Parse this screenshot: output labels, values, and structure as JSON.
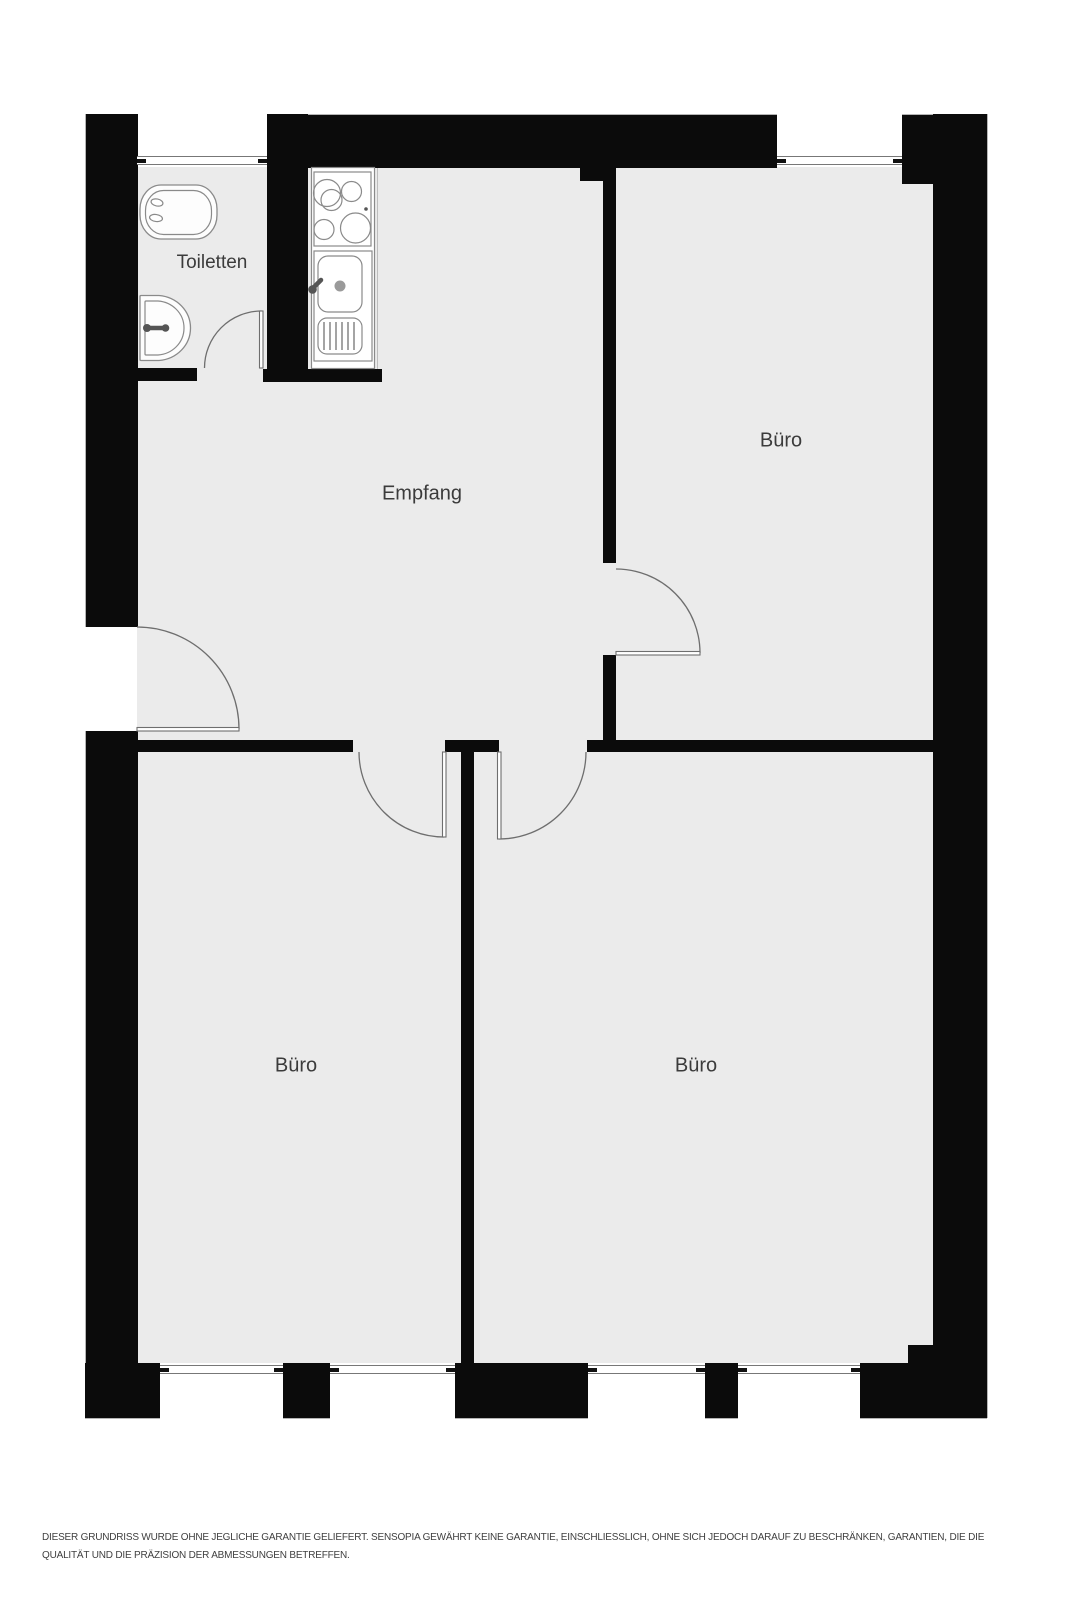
{
  "colors": {
    "wall": "#0b0b0b",
    "floor": "#ebebeb",
    "fixture_outline": "#8a8a8a",
    "label_text": "#3b3b3b",
    "door_arc": "#6e6e6e",
    "disclaimer_text": "#3f3f3f",
    "background": "#ffffff"
  },
  "rooms": {
    "toiletten": {
      "label": "Toiletten"
    },
    "empfang": {
      "label": "Empfang"
    },
    "buero_top_right": {
      "label": "Büro"
    },
    "buero_bottom_left": {
      "label": "Büro"
    },
    "buero_bottom_right": {
      "label": "Büro"
    }
  },
  "fixtures": {
    "toilet": "toilet-icon",
    "washbasin": "washbasin-icon",
    "stove": "stove-icon",
    "kitchen_sink": "kitchen-sink-icon"
  },
  "disclaimer": {
    "line1": "DIESER GRUNDRISS WURDE OHNE JEGLICHE GARANTIE GELIEFERT. SENSOPIA GEWÄHRT KEINE GARANTIE, EINSCHLIESSLICH, OHNE SICH JEDOCH DARAUF ZU BESCHRÄNKEN, GARANTIEN, DIE DIE",
    "line2": "QUALITÄT UND DIE PRÄZISION DER ABMESSUNGEN BETREFFEN."
  }
}
